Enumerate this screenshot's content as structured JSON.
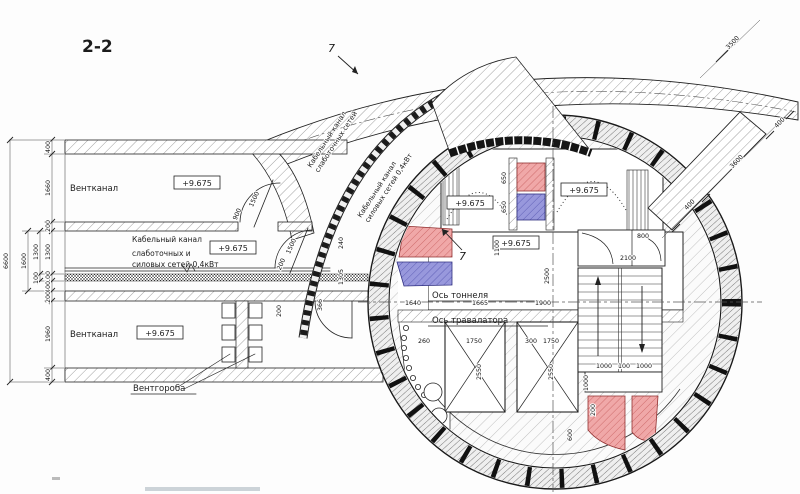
{
  "meta": {
    "drawing_title": "2-2"
  },
  "labels": {
    "vent_channel": "Вентканал",
    "vent_boxes": "Вентгороба",
    "cable_channel_l1": "Кабельный канал",
    "cable_channel_l2": "слаботочных и",
    "cable_channel_l3": "силовых сетей 0,4кВт",
    "arc_weak_l1": "Кабельный канал",
    "arc_weak_l2": "слаботочных сетей",
    "arc_power_l1": "Кабельный канал",
    "arc_power_l2": "силовых сетей 0,4кВт",
    "axis_tunnel": "Ось тоннеля",
    "axis_travelator": "Ось травалатора",
    "callout": "7",
    "elevation": "+9.675"
  },
  "dims": {
    "overall": "6600",
    "chain": [
      "400",
      "1660",
      "200",
      "1300",
      "100",
      "400",
      "200",
      "1960",
      "400"
    ],
    "aux": [
      "1600",
      "1300",
      "100"
    ],
    "door_top": [
      "1500",
      "900"
    ],
    "door_mid": [
      "1500",
      "200"
    ],
    "door_bottom": [
      "200",
      "366"
    ],
    "junction": [
      "240",
      "1305"
    ],
    "fans": [
      "650",
      "650"
    ],
    "room_tr": [
      "1100",
      "800",
      "2100"
    ],
    "hall_height": "2500",
    "floor": [
      "1640",
      "1665",
      "1900"
    ],
    "shafts": [
      "260",
      "1750",
      "300",
      "1750"
    ],
    "shaft_h": [
      "2550",
      "2550"
    ],
    "landing": [
      "1000",
      "100",
      "1000"
    ],
    "landing_h": "1000",
    "misc": [
      "600",
      "200"
    ],
    "diag": [
      "400",
      "3600",
      "400"
    ],
    "diag_top": "3500"
  },
  "colors": {
    "red_fill": "#f0a8a8",
    "red_line": "#c05050",
    "blue_fill": "#9898dc",
    "blue_line": "#4848a8",
    "line": "#1c1c1c"
  }
}
